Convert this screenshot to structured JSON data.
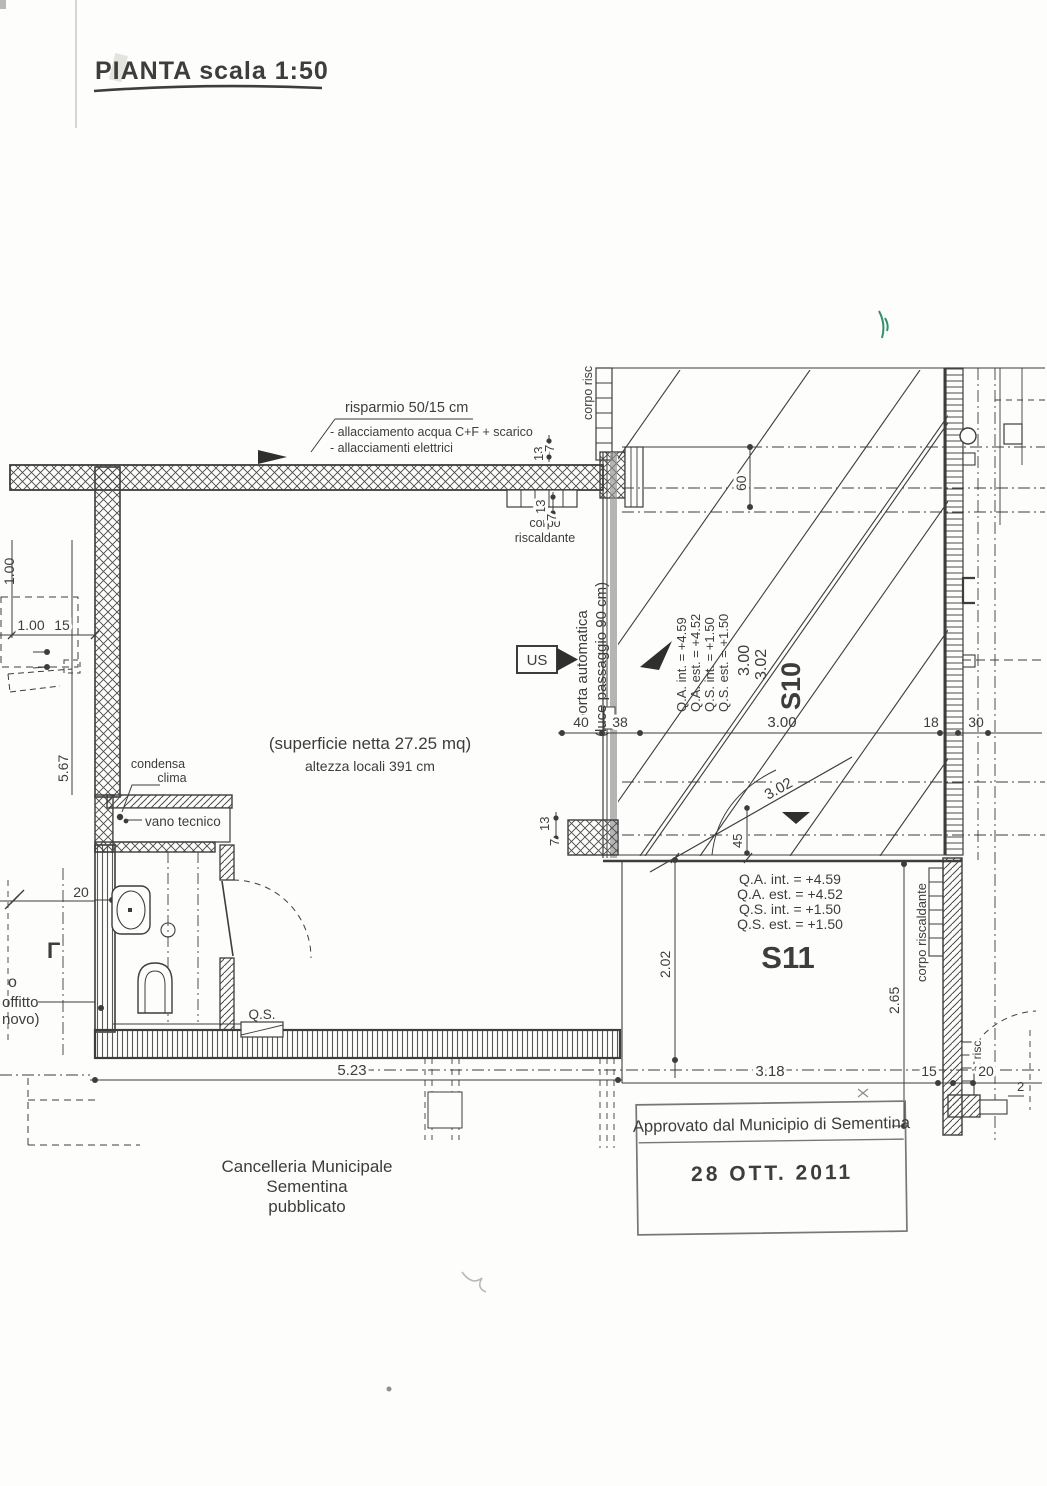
{
  "title": "PIANTA scala 1:50",
  "colors": {
    "ink": "#3d3d3d",
    "stamp_ink": "#6e6e6e",
    "date_ink": "#9b9b9b",
    "office_ink": "#7a7a7a",
    "pen_mark": "#2f8f6f"
  },
  "notes": {
    "risparmio": "risparmio 50/15 cm",
    "acqua": "- allacciamento acqua C+F + scarico",
    "elettrici": "- allacciamenti elettrici",
    "corpo_risc_short": "corpo risc",
    "corpo_line1": "corpo",
    "corpo_line2": "riscaldante",
    "porta_line1": "porta automatica",
    "porta_line2": "(luce passaggio 90 cm)",
    "us": "US",
    "superficie": "(superficie netta 27.25 mq)",
    "altezza": "altezza locali 391 cm",
    "condensa_line1": "condensa",
    "condensa_line2": "clima",
    "vano_tecnico": "vano tecnico",
    "qs": "Q.S.",
    "corpo_riscaldante": "corpo riscaldante",
    "c_risc": "c. risc.",
    "edge_fragments": [
      "o",
      "offitto",
      "novo)"
    ],
    "edge_mark": "Γ"
  },
  "rooms": {
    "s10": {
      "label": "S10",
      "width": "3.00",
      "width2": "3.02",
      "quotes": [
        "Q.A. int. = +4.59",
        "Q.A. est. = +4.52",
        "Q.S. int. = +1.50",
        "Q.S. est. = +1.50"
      ]
    },
    "s11": {
      "label": "S11",
      "quotes": [
        "Q.A. int. = +4.59",
        "Q.A. est. = +4.52",
        "Q.S. int. = +1.50",
        "Q.S. est. = +1.50"
      ]
    }
  },
  "dims": {
    "v100": "1.00",
    "h100": "1.00",
    "h15": "15",
    "v567": "5.67",
    "h20": "20",
    "b523": "5.23",
    "d40": "40",
    "d38": "38",
    "t13a": "13",
    "t7a": "7",
    "t13b": "13",
    "t7b": "7",
    "t13c": "13",
    "t7c": "7",
    "d60": "60",
    "d300": "3.00",
    "d18": "18",
    "d30": "30",
    "ramp302": "3.02",
    "d45": "45",
    "s202": "2.02",
    "s265": "2.65",
    "b318": "3.18",
    "b15": "15",
    "b20": "20",
    "r2": "2"
  },
  "stamps": {
    "approved": "Approvato dal Municipio di Sementina",
    "date": "28 OTT. 2011",
    "office": [
      "Cancelleria Municipale",
      "Sementina",
      "pubblicato"
    ]
  }
}
